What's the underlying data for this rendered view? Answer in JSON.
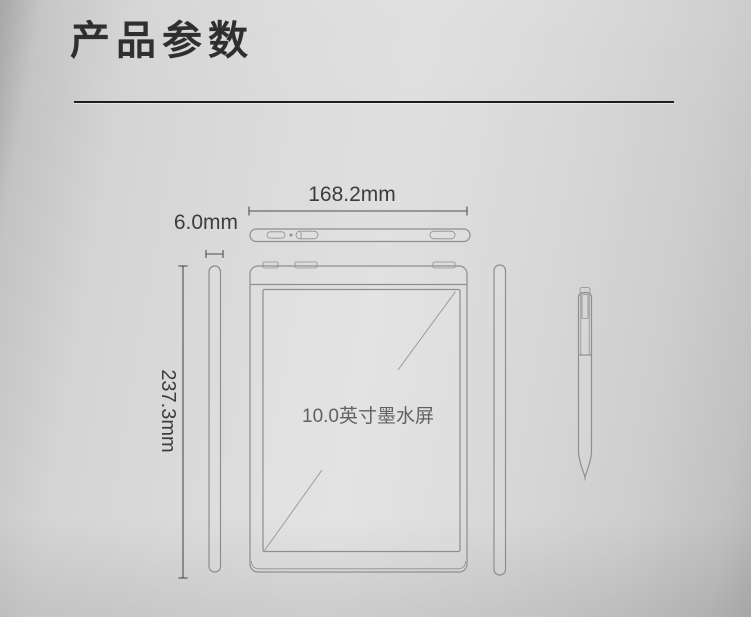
{
  "colors": {
    "outline": "#8e8e8e",
    "dimension": "#4f4f4f",
    "title-text": "#2f2f2f",
    "label-text": "#3d3d3d",
    "screen-text": "#4a4a4a",
    "divider": "#1e1e1e"
  },
  "header": {
    "title": "产品参数"
  },
  "diagram": {
    "width_label": "168.2mm",
    "thickness_label": "6.0mm",
    "height_label": "237.3mm",
    "screen_label": "10.0英寸墨水屏"
  }
}
